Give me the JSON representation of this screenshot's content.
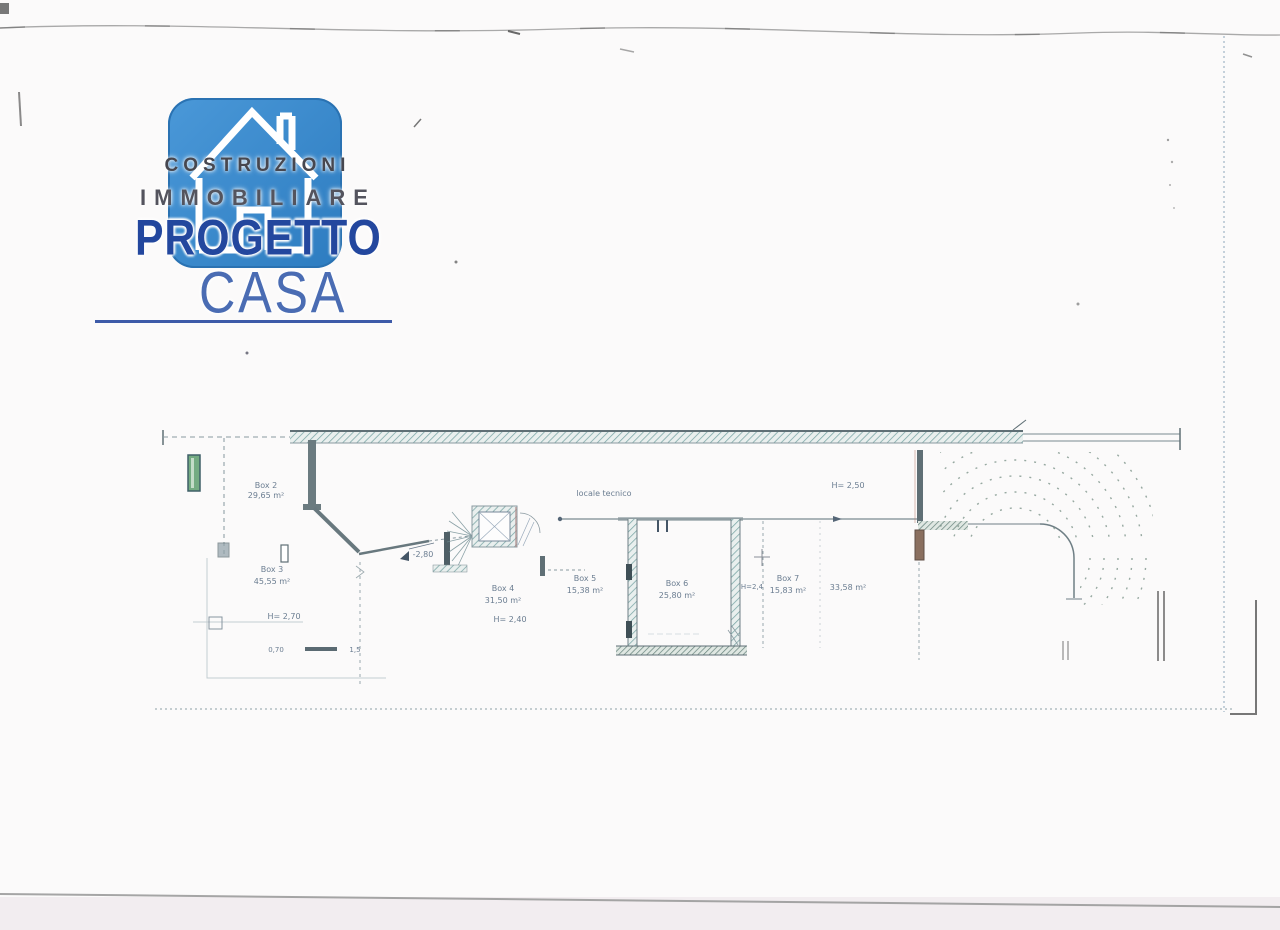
{
  "logo": {
    "line1": "COSTRUZIONI",
    "line2": "IMMOBILIARE",
    "line3": "PROGETTO",
    "line4": "CASA",
    "icon": "house-icon",
    "colors": {
      "square": "#3c8ed2",
      "line1": "#47474f",
      "line2": "#54545e",
      "line3": "#23479e",
      "line4": "#4a6cb3",
      "underline": "#3d5aa8"
    }
  },
  "plan": {
    "note": "locale tecnico",
    "level_marker": "-2,80",
    "rooms": [
      {
        "name": "Box 2",
        "area": "29,65 m²",
        "height": ""
      },
      {
        "name": "Box 3",
        "area": "45,55 m²",
        "height": "H= 2,70"
      },
      {
        "name": "Box 4",
        "area": "31,50 m²",
        "height": "H= 2,40"
      },
      {
        "name": "Box 5",
        "area": "15,38 m²",
        "height": ""
      },
      {
        "name": "Box 6",
        "area": "25,80 m²",
        "height": ""
      },
      {
        "name": "Box 7",
        "area": "15,83 m²",
        "height": "H=2,4"
      },
      {
        "name": "",
        "area": "33,58 m²",
        "height": "H= 2,50"
      }
    ],
    "dimensions": [
      "0,70",
      "1,5"
    ],
    "wall_color": "#6b7b80",
    "hatch_color": "#79a5a5"
  }
}
